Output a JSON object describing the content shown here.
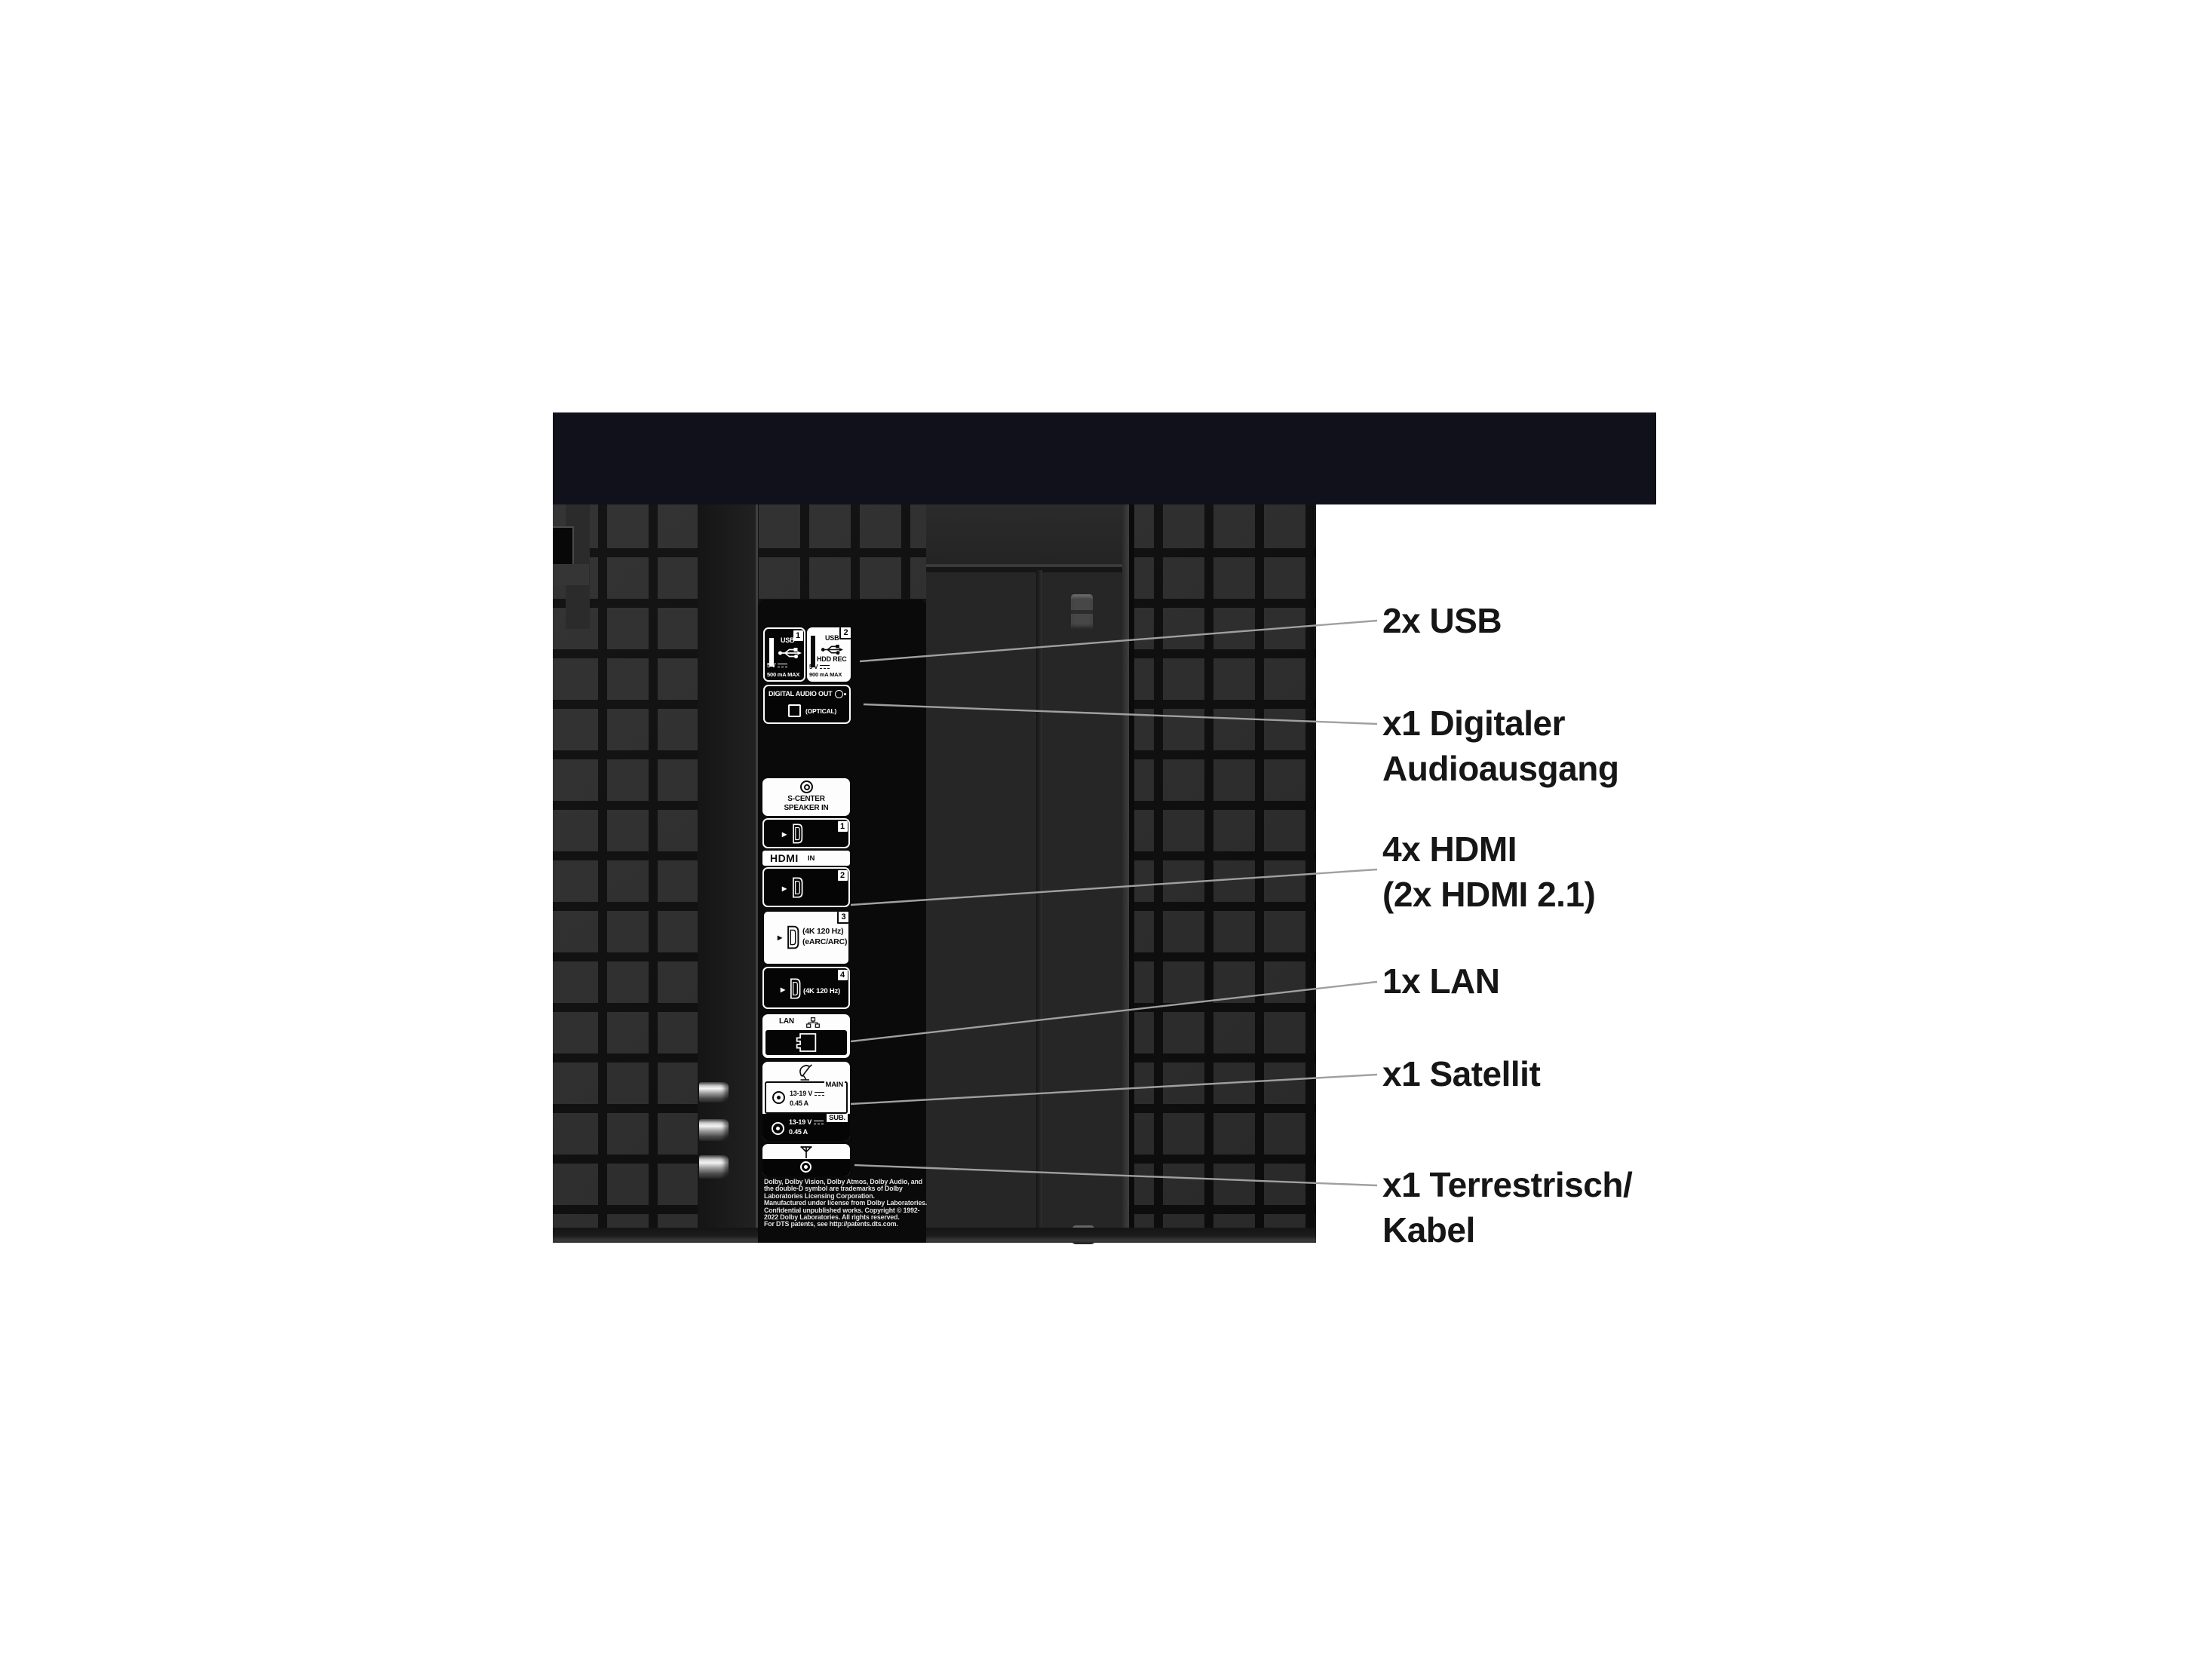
{
  "annotations": [
    {
      "id": "usb",
      "lines": [
        "2x USB"
      ]
    },
    {
      "id": "digital-audio",
      "lines": [
        "x1 Digitaler",
        "Audioausgang"
      ]
    },
    {
      "id": "hdmi",
      "lines": [
        "4x HDMI",
        "(2x HDMI 2.1)"
      ]
    },
    {
      "id": "lan",
      "lines": [
        "1x LAN"
      ]
    },
    {
      "id": "satellite",
      "lines": [
        "x1 Satellit"
      ]
    },
    {
      "id": "terrestrial",
      "lines": [
        "x1 Terrestrisch/",
        "Kabel"
      ]
    }
  ],
  "ports": {
    "usb1": {
      "number": "1",
      "label": "USB",
      "voltage": "5 V",
      "current": "500 mA MAX"
    },
    "usb2": {
      "number": "2",
      "label": "USB",
      "mode": "HDD REC",
      "voltage": "5 V",
      "current": "900 mA MAX"
    },
    "digital_audio_out": {
      "title": "DIGITAL AUDIO OUT",
      "connector": "(OPTICAL)"
    },
    "s_center": {
      "line1": "S-CENTER",
      "line2": "SPEAKER IN"
    },
    "hdmi": {
      "logo": "HDMI",
      "direction": "IN",
      "num1": "1",
      "num2": "2",
      "num3": "3",
      "num4": "4",
      "spec_4k": "(4K 120 Hz)",
      "spec_earc": "(eARC/ARC)"
    },
    "lan": {
      "label": "LAN"
    },
    "satellite": {
      "main_tab": "MAIN",
      "sub_tab": "SUB.",
      "voltage": "13-19 V",
      "current": "0.45 A"
    }
  },
  "fine_print": [
    "Dolby, Dolby Vision, Dolby Atmos, Dolby Audio, and",
    "the double-D symbol are trademarks of Dolby",
    "Laboratories Licensing Corporation.",
    "Manufactured under license from Dolby Laboratories.",
    "Confidential unpublished works. Copyright © 1992-",
    "2022 Dolby Laboratories. All rights reserved.",
    "For DTS patents, see http://patents.dts.com."
  ],
  "colors": {
    "background": "#ffffff",
    "tv_top_bar": "#11111b",
    "panel_tile": "#2d2d2d",
    "panel_gap": "#0d0d0d",
    "bay": "#0a0a0a",
    "label_text": "#161616",
    "pointer_line": "#a0a0a0"
  }
}
